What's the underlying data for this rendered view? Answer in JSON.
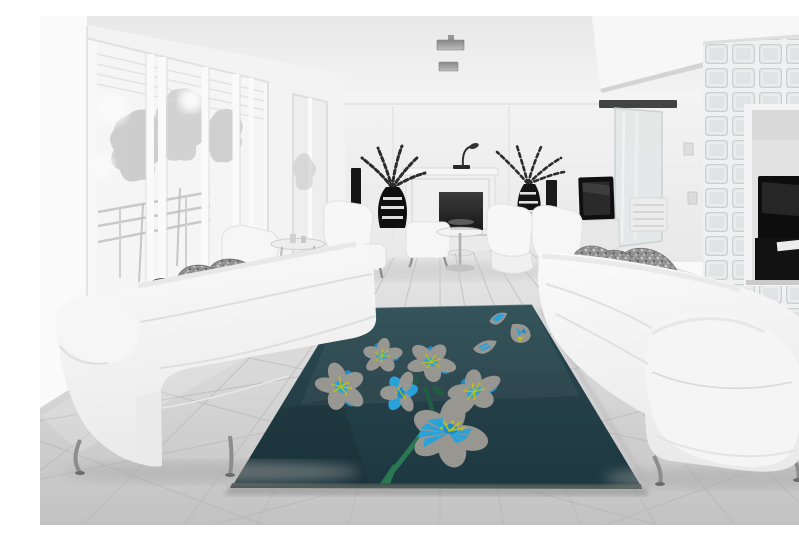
{
  "meta": {
    "description": "Black-and-white photograph of a modern living room with two white leather sofas facing each other across a dark teal area rug decorated with gray and blue cherry-blossom flowers, a white fireplace, potted plants, panoramic windows on the left and a glass-block partition wall on the right"
  },
  "palette": {
    "rug-top": "#2C4D55",
    "rug-mid": "#26424A",
    "rug-bottom": "#1E3A42",
    "rug-edge": "#46544F",
    "petal-gray": "#9B9A93",
    "flower-blue": "#1E8FC9",
    "flower-blue-bright": "#2AA6DF",
    "stamen-yellow": "#BEC31F",
    "stem-green": "#2B7A56",
    "stem-green-dark": "#225F45",
    "wall": "#F4F4F4",
    "ceiling": "#F7F7F7",
    "floor-light": "#EBEBEB",
    "floor-dark": "#C6C6C6",
    "grout": "#B8B8B8",
    "sofa-white": "#FAFAFA",
    "sofa-shade": "#E6E6E6",
    "pillow-dark": "#333333",
    "pillow-speckle": "#989898",
    "firebox": "#1A1A1A",
    "plant-dark": "#2D2D2D",
    "glass-block": "#E6E9E9",
    "doorway-dark": "#131313",
    "chrome": "#909090"
  },
  "scene": {
    "photo_style": "grayscale interior, rug is the only colored element",
    "objects": [
      "panoramic windows with tree silhouettes",
      "white column",
      "ceiling light fixtures",
      "white fireplace with dark firebox",
      "arc lamp on mantel",
      "two potted plants in striped vases",
      "two dark floor speakers",
      "white armchairs with ottomans",
      "round glass side table",
      "white leather sofa left",
      "white leather sofa right",
      "dark accent pillow",
      "gray patterned throw pillows",
      "wall mounted tv",
      "sliding glass door",
      "glass block partition wall",
      "doorway with tv room",
      "large format tile floor",
      "dark teal floral area rug"
    ],
    "rug": {
      "background": "dark teal",
      "pattern": "cherry blossom branch with falling petals",
      "flower_count": 6,
      "falling_petals": 3,
      "colors": [
        "warm gray petals",
        "azure blue accents",
        "chartreuse stamens",
        "green stem"
      ]
    }
  }
}
